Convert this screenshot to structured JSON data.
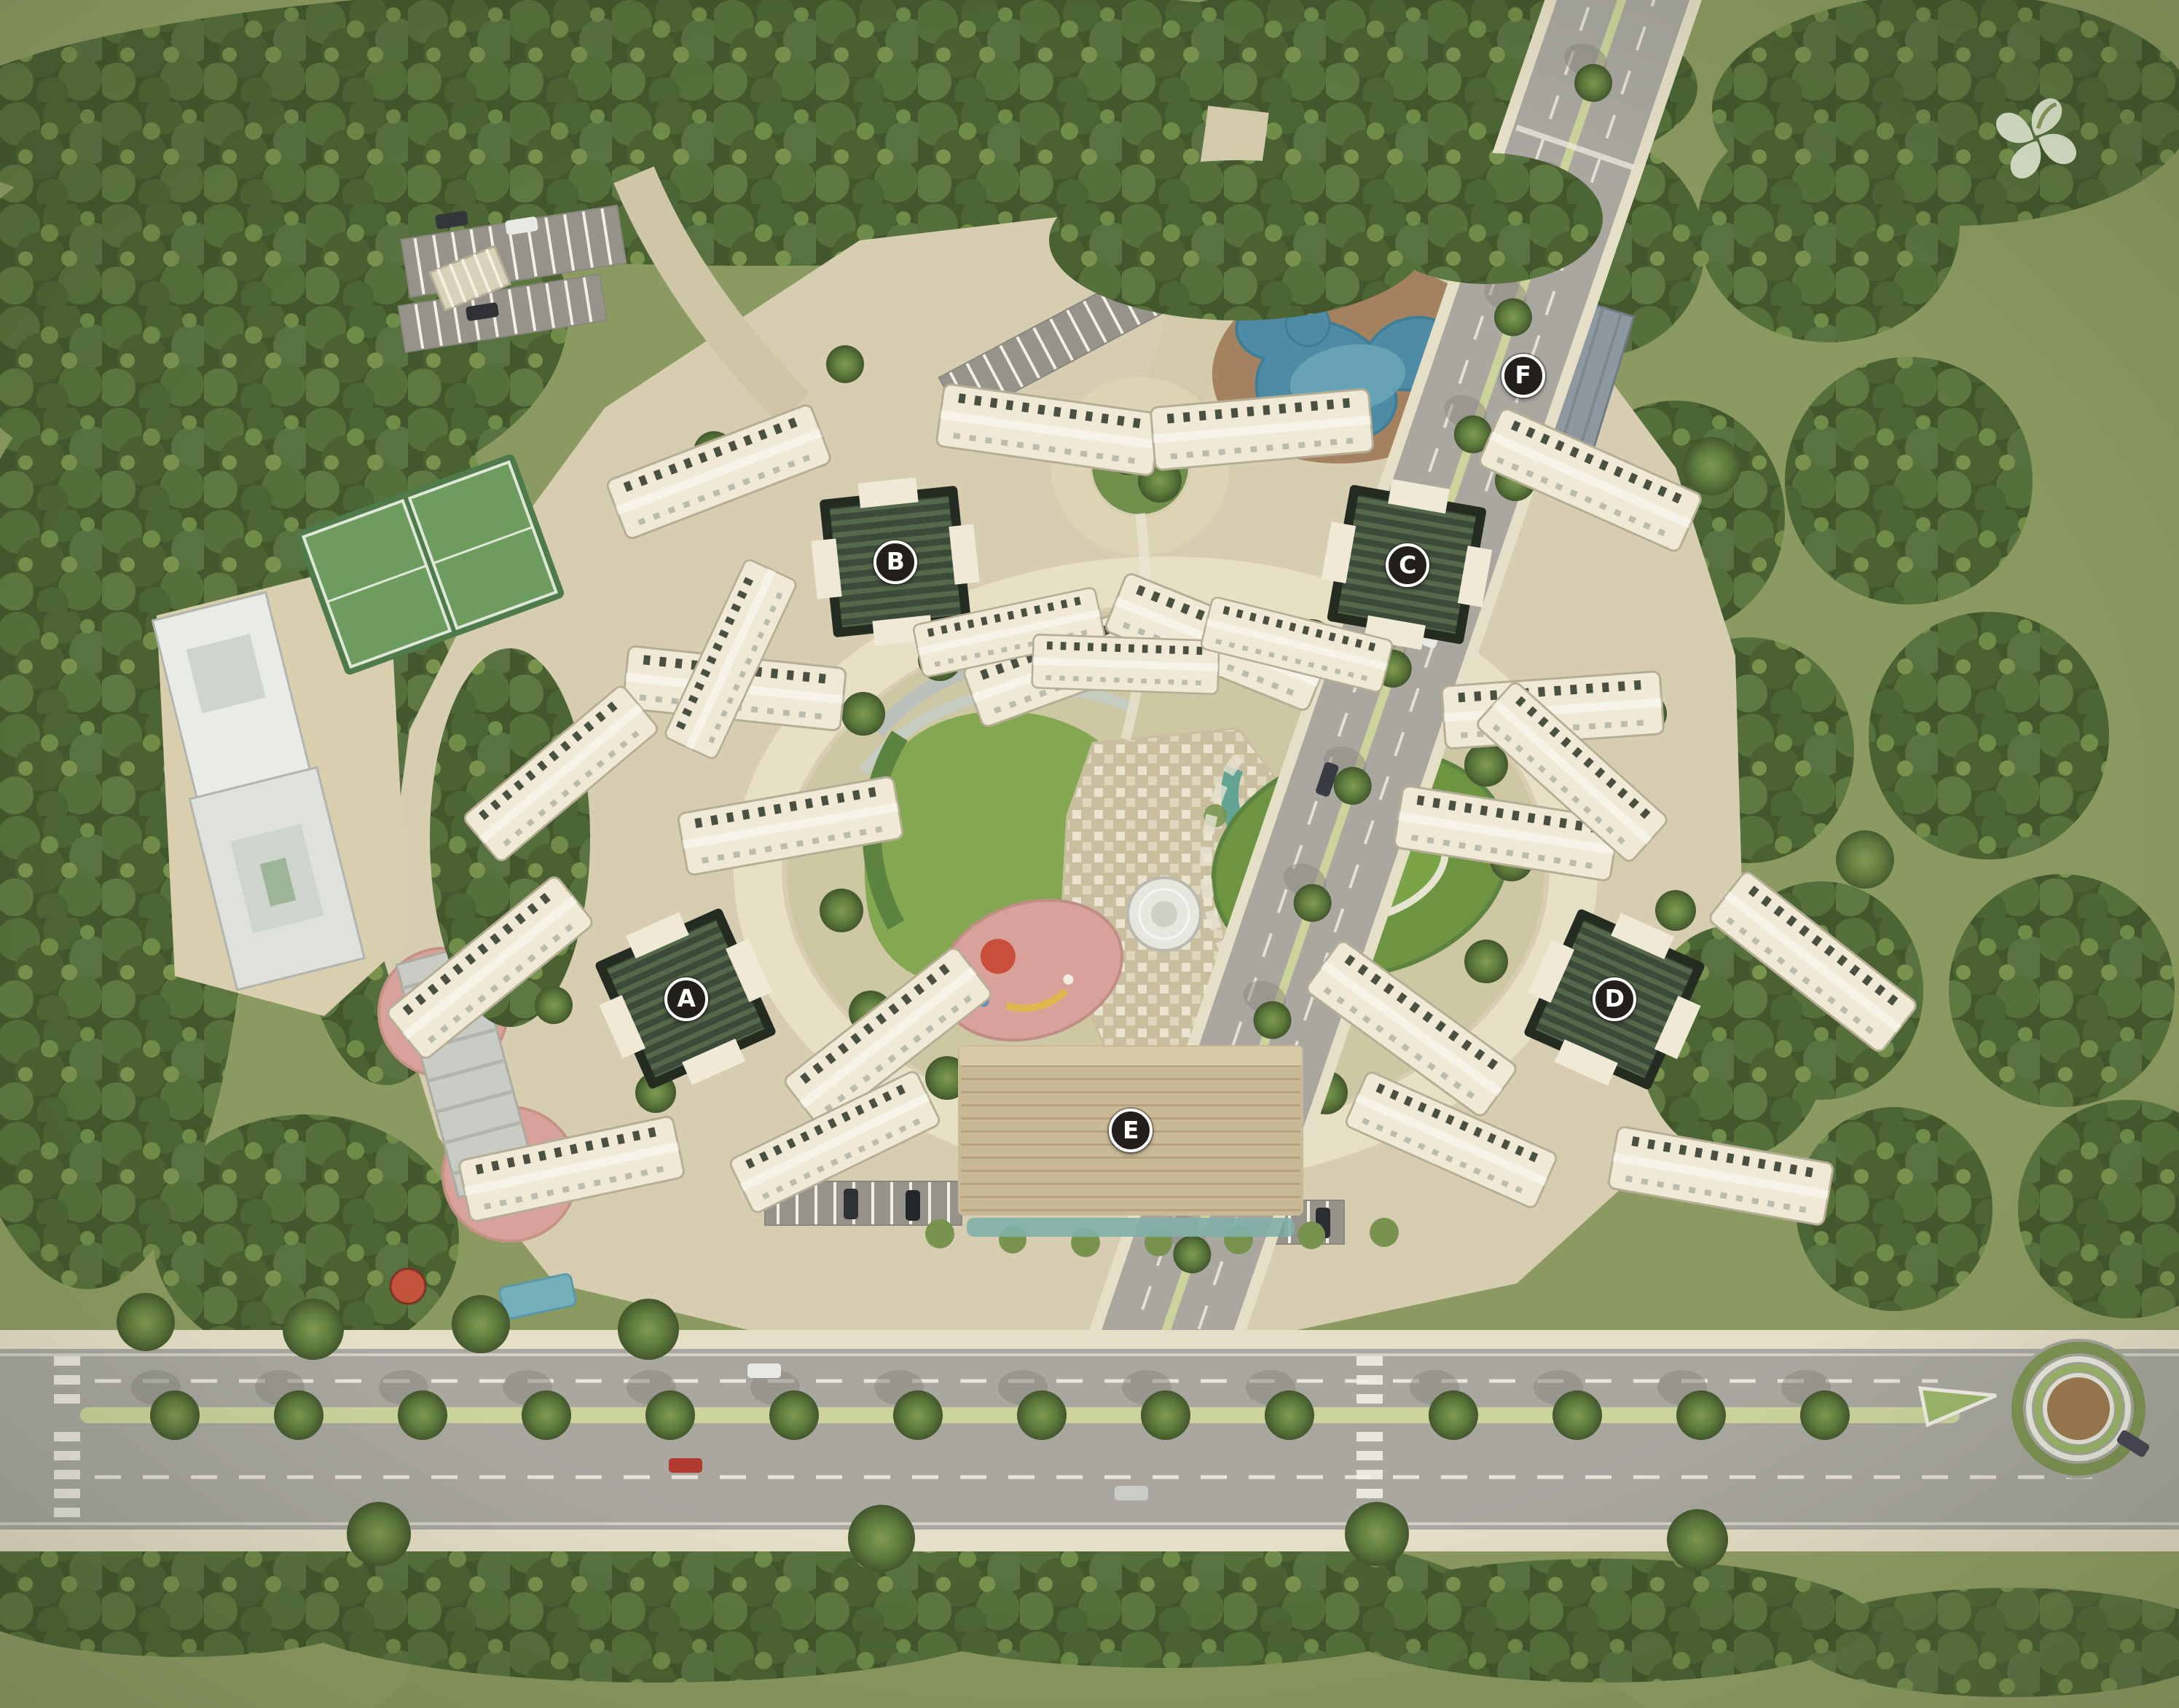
{
  "meta": {
    "title": "Residential complex master plan - aerial site rendering",
    "view": "top-down"
  },
  "markers": [
    {
      "label": "A",
      "x_pct": 31.5,
      "y_pct": 58.5
    },
    {
      "label": "B",
      "x_pct": 41.1,
      "y_pct": 32.9
    },
    {
      "label": "C",
      "x_pct": 64.6,
      "y_pct": 33.1
    },
    {
      "label": "D",
      "x_pct": 74.1,
      "y_pct": 58.5
    },
    {
      "label": "E",
      "x_pct": 51.9,
      "y_pct": 66.2
    },
    {
      "label": "F",
      "x_pct": 69.9,
      "y_pct": 22.0
    }
  ],
  "logo": {
    "icon": "flower-petal-logo",
    "color": "#dfe7cf"
  },
  "features": {
    "perimeter": "dense-tree-buffer",
    "main_road": "tree-lined-boulevard",
    "side_road": "secondary-road",
    "roundabout": "roundabout",
    "pool": "swimming-pool",
    "clubhouse_f": "clubhouse",
    "hall_e": "community-hall",
    "towers": "residential-towers",
    "garden": "central-landscaped-garden",
    "lawn_west": "kidney-lawn",
    "lawn_east": "oval-lawn",
    "playground": "children-playground",
    "fountain": "circular-fountain",
    "stream": "water-stream",
    "plaza": "paved-plaza",
    "court": "sports-courts",
    "school": "campus-building",
    "pergola": "pergola",
    "parking": "surface-parking",
    "median": "planted-median",
    "crosswalk": "zebra-crossing",
    "entrance": "entry-court"
  },
  "colors": {
    "grass": "#8b9a60",
    "grass_light": "#99a66c",
    "canopy": "#42572c",
    "tree_mid": "#5d7840",
    "tree_light": "#77934e",
    "parcel": "#d7ceb1",
    "ring_road": "#e7e0c5",
    "drive": "#d3caac",
    "road": "#a9a7a0",
    "sidewalk": "#e6dfc7",
    "road_line": "#f2efe6",
    "median": "#ccd39b",
    "building": "#efe9d6",
    "building_edge": "#b5ae95",
    "roof_dark": "#3c4a39",
    "roof_stripe": "#55684a",
    "hall": "#c9b997",
    "school": "#e9ebe6",
    "apron": "#d9cfae",
    "lawn": "#84a852",
    "lawn_deep": "#6d9440",
    "plaza": "#c9bf9f",
    "pool": "#4e8ba4",
    "pool_light": "#78b2c2",
    "deck": "#a17c5b",
    "stream": "#63a392",
    "fountain": "#e7e6df",
    "court": "#4f7a49",
    "court_light": "#6e9b5e",
    "play_pink": "#d8a29b",
    "play_red": "#c94f3a",
    "play_yellow": "#e0b64e",
    "clubhouse": "#8d98a0",
    "pergola": "#c9ccc4",
    "roundabout_green": "#7f9454",
    "roundabout_island": "#9cb86a",
    "roundabout_center": "#9e7a52",
    "marker_bg": "#221f1a",
    "marker_ring": "#ffffff",
    "marker_text": "#ffffff",
    "car_white": "#e8e8e4",
    "car_red": "#b23a2e",
    "car_dark": "#33363b"
  }
}
